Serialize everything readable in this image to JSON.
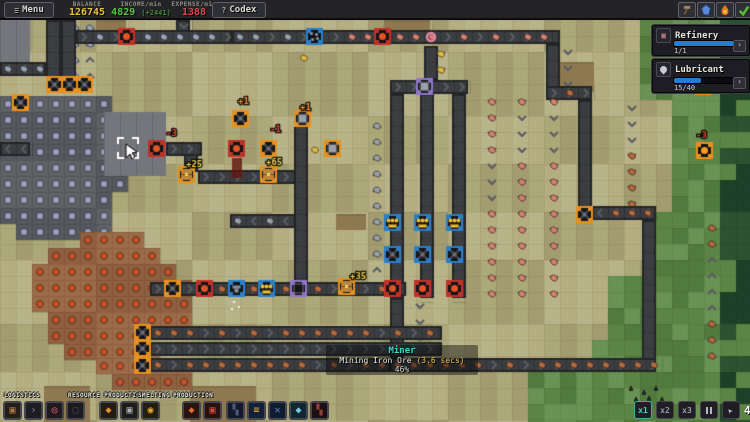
{
  "top_bar": {
    "menu_icon": "≡",
    "menu_label": "Menu",
    "codex_icon": "?",
    "codex_label": "Codex",
    "stats": [
      {
        "label": "BALANCE",
        "value": "126745",
        "color": "#e8c23a"
      },
      {
        "label": "INCOME/min",
        "value": "4829",
        "extra": "(+2441)",
        "color": "#55c83c",
        "extra_color": "#3f8a34"
      },
      {
        "label": "EXPENSE/min",
        "value": "1388",
        "color": "#e04848"
      }
    ],
    "tool_buttons": [
      {
        "name": "hammer-icon"
      },
      {
        "name": "crystal-icon"
      },
      {
        "name": "flame-icon"
      },
      {
        "name": "check-icon"
      }
    ]
  },
  "panels": [
    {
      "title": "Refinery",
      "icon": "refinery-icon",
      "count": "1/1",
      "progress": 1.0,
      "bar_color": "#1f7fd4"
    },
    {
      "title": "Lubricant",
      "icon": "droplet-icon",
      "count": "15/40",
      "progress": 0.375,
      "bar_color": "#1f7fd4"
    }
  ],
  "tooltip": {
    "title": "Miner",
    "line": "Mining Iron Ore ",
    "time": "(3.6 secs)",
    "percent": "46%"
  },
  "build_toolbar": {
    "groups": [
      {
        "label": "LOGISTICS",
        "label_x": 4,
        "x": 3,
        "slots": [
          {
            "name": "conveyor",
            "glyph": "▣",
            "color": "#b07a48",
            "bg": "#242018"
          },
          {
            "name": "arrow",
            "glyph": "›",
            "color": "#8a8a92",
            "bg": "#1c1c22"
          },
          {
            "name": "tunnel",
            "glyph": "◎",
            "color": "#e06878",
            "bg": "#201a1e"
          },
          {
            "name": "splitter",
            "glyph": "▢",
            "color": "#4a4a52",
            "bg": "#1a1a20"
          }
        ]
      },
      {
        "label": "RESOURCE PRODUCTION",
        "label_x": 68,
        "x": 99,
        "slots": [
          {
            "name": "miner",
            "glyph": "◆",
            "color": "#e89028",
            "bg": "#221c12"
          },
          {
            "name": "quarry",
            "glyph": "▣",
            "color": "#b0b0b8",
            "bg": "#1e1c18"
          },
          {
            "name": "pump",
            "glyph": "◉",
            "color": "#e8a830",
            "bg": "#221e12"
          }
        ]
      },
      {
        "label": "SMELTING",
        "label_x": 138,
        "x": 182,
        "slots": [
          {
            "name": "furnace",
            "glyph": "◆",
            "color": "#e86830",
            "bg": "#2a1410"
          },
          {
            "name": "blast-furnace",
            "glyph": "▣",
            "color": "#d84838",
            "bg": "#281210"
          }
        ]
      },
      {
        "label": "PRODUCTION",
        "label_x": 173,
        "x": 226,
        "slots": [
          {
            "name": "assembler",
            "glyph": "▚",
            "color": "#4a5a78",
            "bg": "#14182a"
          },
          {
            "name": "mint",
            "glyph": "≡",
            "color": "#e8a838",
            "bg": "#12203a"
          },
          {
            "name": "factory",
            "glyph": "✕",
            "color": "#5888c8",
            "bg": "#101c30"
          },
          {
            "name": "gem-lab",
            "glyph": "◆",
            "color": "#78c8e8",
            "bg": "#102830"
          },
          {
            "name": "forge",
            "glyph": "▚",
            "color": "#904038",
            "bg": "#1e1012"
          }
        ]
      }
    ]
  },
  "speed_controls": {
    "buttons": [
      {
        "name": "speed-x1",
        "label": "x1",
        "active": true
      },
      {
        "name": "speed-x2",
        "label": "x2"
      },
      {
        "name": "speed-x3",
        "label": "x3"
      },
      {
        "name": "pause",
        "type": "pause"
      },
      {
        "name": "select-tool",
        "type": "cursor"
      }
    ],
    "counter": "4",
    "extra_button": {
      "name": "select-tool-2",
      "type": "cursor"
    }
  },
  "map": {
    "tile": 16,
    "olive": [
      "#aca878",
      "#b4ae80",
      "#a29c70",
      "#b9b389"
    ],
    "greens": [
      "#5c8445",
      "#527a3e",
      "#699254"
    ],
    "dark_greens": [
      "#2d5230",
      "#1e4028"
    ],
    "green_rows": [
      [
        20,
        96,
        640
      ],
      [
        96,
        200,
        662
      ],
      [
        200,
        264,
        644
      ],
      [
        264,
        330,
        606
      ],
      [
        330,
        358,
        580
      ],
      [
        358,
        422,
        518
      ]
    ],
    "dirt": [
      [
        384,
        20,
        46,
        14
      ],
      [
        190,
        386,
        66,
        36
      ],
      [
        44,
        386,
        46,
        36
      ],
      [
        336,
        214,
        30,
        16
      ],
      [
        560,
        62,
        34,
        30
      ],
      [
        96,
        20,
        30,
        14
      ]
    ],
    "stone_patch": {
      "tile": "#5f6167",
      "tile2": "#565860",
      "dot": "#97a0b5",
      "rows": [
        [
          0,
          96,
          104,
          48
        ],
        [
          0,
          144,
          120,
          48
        ],
        [
          0,
          192,
          104,
          32
        ],
        [
          16,
          224,
          88,
          14
        ]
      ]
    },
    "concrete": {
      "color": "#74767b",
      "rects": [
        [
          104,
          112,
          62,
          64
        ],
        [
          0,
          20,
          30,
          44
        ]
      ]
    },
    "iron_patch": {
      "tile": "#9c6c49",
      "tile2": "#8f6040",
      "dot": "#c1512d",
      "rows": [
        [
          80,
          232,
          64,
          16
        ],
        [
          48,
          248,
          112,
          16
        ],
        [
          32,
          264,
          144,
          16
        ],
        [
          32,
          280,
          148,
          16
        ],
        [
          32,
          296,
          148,
          16
        ],
        [
          48,
          312,
          132,
          16
        ],
        [
          48,
          328,
          88,
          16
        ],
        [
          64,
          344,
          88,
          16
        ],
        [
          96,
          358,
          96,
          16
        ],
        [
          112,
          374,
          78,
          10
        ]
      ]
    },
    "belt_color": "#3b3d41",
    "belt_edge": "#232527",
    "chevron": "#5a5d64",
    "item_colors": {
      "stone": "#97a0b5",
      "pink": "#d4806c",
      "iron": "#b5693f",
      "gray": "#9aa0a8",
      "gold": "#e0b840",
      "none": ""
    },
    "belts": [
      [
        0,
        62,
        46,
        14,
        "l",
        "stone"
      ],
      [
        46,
        20,
        15,
        58,
        "u",
        "stone"
      ],
      [
        61,
        20,
        15,
        58,
        "u",
        "stone"
      ],
      [
        76,
        30,
        156,
        14,
        "r",
        "stone"
      ],
      [
        176,
        20,
        14,
        12,
        "d",
        "none"
      ],
      [
        232,
        30,
        82,
        14,
        "r",
        "stone"
      ],
      [
        312,
        30,
        248,
        14,
        "r",
        "pink"
      ],
      [
        546,
        44,
        14,
        44,
        "d",
        "iron"
      ],
      [
        546,
        86,
        46,
        14,
        "r",
        "iron"
      ],
      [
        578,
        100,
        14,
        108,
        "d",
        "iron"
      ],
      [
        592,
        206,
        64,
        14,
        "l",
        "iron"
      ],
      [
        642,
        220,
        14,
        140,
        "u",
        "iron"
      ],
      [
        390,
        358,
        266,
        14,
        "r",
        "iron"
      ],
      [
        390,
        298,
        14,
        60,
        "d",
        "none"
      ],
      [
        390,
        94,
        14,
        204,
        "d",
        "pink"
      ],
      [
        420,
        94,
        14,
        204,
        "d",
        "pink"
      ],
      [
        452,
        94,
        14,
        204,
        "d",
        "pink"
      ],
      [
        390,
        80,
        78,
        14,
        "r",
        "none"
      ],
      [
        424,
        46,
        14,
        34,
        "d",
        "gold"
      ],
      [
        294,
        118,
        14,
        166,
        "u",
        "gray"
      ],
      [
        230,
        214,
        66,
        14,
        "l",
        "gray"
      ],
      [
        166,
        142,
        36,
        14,
        "r",
        "none"
      ],
      [
        184,
        154,
        14,
        18,
        "d",
        "none"
      ],
      [
        198,
        170,
        98,
        14,
        "r",
        "none"
      ],
      [
        0,
        142,
        30,
        14,
        "l",
        "none"
      ],
      [
        150,
        282,
        256,
        14,
        "r",
        "iron"
      ],
      [
        150,
        326,
        292,
        14,
        "r",
        "iron"
      ],
      [
        150,
        342,
        292,
        14,
        "r",
        "none"
      ],
      [
        150,
        358,
        240,
        14,
        "r",
        "iron"
      ]
    ],
    "frame_colors": {
      "orange": "#e6901e",
      "red": "#c03228",
      "blue": "#2a7fc9",
      "purple": "#8f76c9"
    },
    "machines": [
      [
        46,
        76,
        "fan",
        "orange"
      ],
      [
        61,
        76,
        "fan",
        "orange"
      ],
      [
        76,
        76,
        "fan",
        "orange"
      ],
      [
        12,
        94,
        "fan",
        "orange"
      ],
      [
        134,
        324,
        "fan",
        "orange"
      ],
      [
        134,
        340,
        "fan",
        "orange"
      ],
      [
        134,
        357,
        "fan",
        "orange"
      ],
      [
        164,
        280,
        "fan",
        "orange"
      ],
      [
        118,
        28,
        "dot",
        "red"
      ],
      [
        374,
        28,
        "dot",
        "red"
      ],
      [
        148,
        140,
        "dot",
        "red"
      ],
      [
        228,
        140,
        "dot",
        "red"
      ],
      [
        196,
        280,
        "dot",
        "red"
      ],
      [
        384,
        280,
        "dot",
        "red"
      ],
      [
        414,
        280,
        "dot",
        "red"
      ],
      [
        446,
        280,
        "dot",
        "red"
      ],
      [
        232,
        110,
        "fan",
        "orange"
      ],
      [
        294,
        110,
        "square",
        "orange"
      ],
      [
        260,
        140,
        "fan",
        "orange"
      ],
      [
        324,
        140,
        "square",
        "orange"
      ],
      [
        306,
        28,
        "crusher",
        "blue"
      ],
      [
        228,
        280,
        "anvil",
        "blue"
      ],
      [
        258,
        280,
        "coins",
        "blue"
      ],
      [
        384,
        214,
        "coins",
        "blue"
      ],
      [
        414,
        214,
        "coins",
        "blue"
      ],
      [
        446,
        214,
        "coins",
        "blue"
      ],
      [
        384,
        246,
        "fan",
        "blue"
      ],
      [
        414,
        246,
        "fan",
        "blue"
      ],
      [
        446,
        246,
        "fan",
        "blue"
      ],
      [
        290,
        280,
        "empty",
        "purple"
      ],
      [
        416,
        78,
        "square",
        "purple"
      ],
      [
        178,
        166,
        "chest",
        "orange"
      ],
      [
        260,
        166,
        "chest",
        "orange"
      ],
      [
        338,
        278,
        "chest",
        "orange"
      ],
      [
        576,
        206,
        "fan",
        "orange"
      ],
      [
        694,
        78,
        "fan",
        "orange"
      ],
      [
        696,
        142,
        "dot",
        "orange"
      ]
    ],
    "floating_texts": [
      [
        238,
        104,
        "+1",
        "#ff9030"
      ],
      [
        300,
        110,
        "+1",
        "#ff9030"
      ],
      [
        270,
        132,
        "-1",
        "#ef4438"
      ],
      [
        166,
        136,
        "-3",
        "#ef4438"
      ],
      [
        186,
        167,
        "+25",
        "#ecd34c"
      ],
      [
        266,
        165,
        "+65",
        "#ecd34c"
      ],
      [
        350,
        279,
        "+35",
        "#ecd34c"
      ],
      [
        700,
        74,
        "-1",
        "#ef4438"
      ],
      [
        696,
        138,
        "-3",
        "#ef4438"
      ]
    ],
    "loose_gold": [
      [
        304,
        58
      ],
      [
        315,
        150
      ]
    ],
    "ring_item": [
      431,
      37
    ],
    "rocks": [
      [
        629,
        388
      ],
      [
        642,
        392
      ],
      [
        654,
        388
      ],
      [
        647,
        398
      ],
      [
        660,
        399
      ],
      [
        634,
        399
      ]
    ],
    "smoke": [
      232,
      158,
      10,
      20
    ],
    "selection": [
      118,
      138,
      20,
      20
    ],
    "cursor": [
      126,
      144
    ],
    "sparkles": [
      [
        233,
        301
      ],
      [
        238,
        306
      ],
      [
        231,
        308
      ]
    ]
  }
}
